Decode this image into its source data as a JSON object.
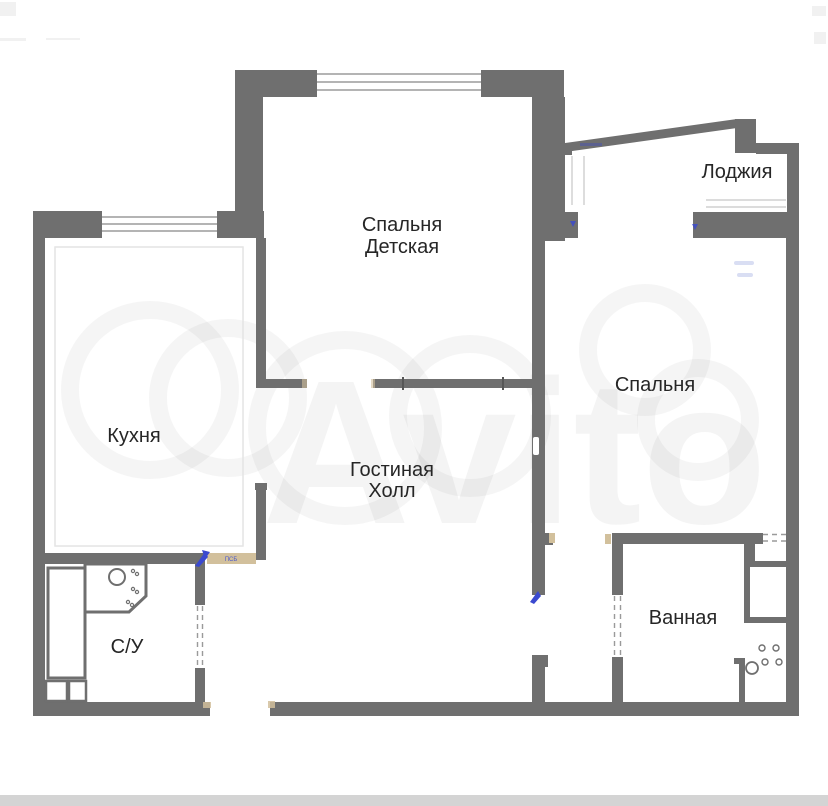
{
  "watermark": {
    "brand": "Avito"
  },
  "rooms": {
    "children_bedroom": {
      "line1": "Спальня",
      "line2": "Детская"
    },
    "loggia": {
      "label": "Лоджия"
    },
    "kitchen": {
      "label": "Кухня"
    },
    "bedroom": {
      "label": "Спальня"
    },
    "living_hall": {
      "line1": "Гостиная",
      "line2": "Холл"
    },
    "bathroom": {
      "label": "Ванная"
    },
    "wc": {
      "label": "С/У"
    }
  },
  "annotations": {
    "kitchen_door_sill": "ПСБ"
  },
  "colors": {
    "wall": "#6f6f6f",
    "label": "#262626",
    "background": "#ffffff",
    "window_line": "#9c9c9c",
    "dash": "#9a9a9a",
    "door_sill": "#d2c09c",
    "accent_blue": "#3a49cf",
    "bottom_strip": "#d4d4d4"
  }
}
